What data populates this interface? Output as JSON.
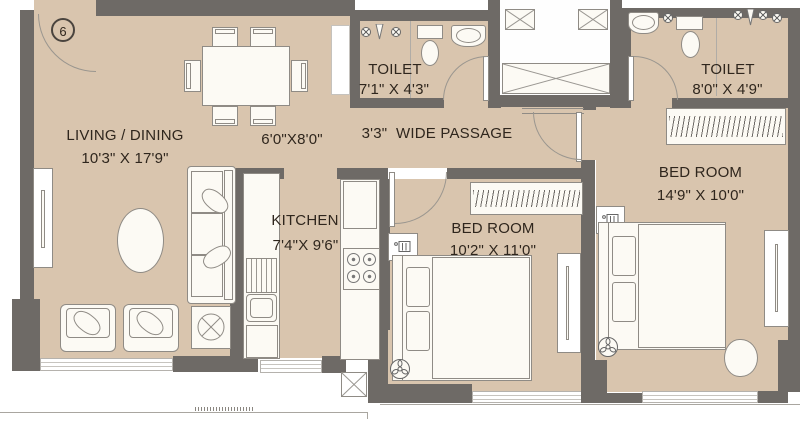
{
  "unit": {
    "number": "6"
  },
  "rooms": {
    "living": {
      "name": "LIVING / DINING",
      "dim": "10'3\" X 17'9\""
    },
    "foyer": {
      "dim": "6'0\"X8'0\""
    },
    "passage": {
      "name": "3'3\"  WIDE PASSAGE"
    },
    "toilet1": {
      "name": "TOILET",
      "dim": "7'1\" X 4'3\""
    },
    "toilet2": {
      "name": "TOILET",
      "dim": "8'0\" X 4'9\""
    },
    "kitchen": {
      "name": "KITCHEN",
      "dim": "7'4\"X 9'6\""
    },
    "bedroom1": {
      "name": "BED ROOM",
      "dim": "10'2\" X 11'0\""
    },
    "bedroom2": {
      "name": "BED ROOM",
      "dim": "14'9\" X 10'0\""
    }
  },
  "furniture": {
    "living": [
      "dining-table",
      "six-dining-chairs",
      "sofa",
      "two-armchairs",
      "oval-coffee-table",
      "tv-unit",
      "decor-table"
    ],
    "kitchen": [
      "sink-counter",
      "drainboard",
      "refrigerator",
      "gas-stove",
      "tall-cabinet"
    ],
    "bedroom1": [
      "double-bed",
      "wardrobe",
      "phone-side-table",
      "ceiling-fan",
      "dresser"
    ],
    "bedroom2": [
      "double-bed",
      "wardrobe",
      "phone-side-table",
      "ceiling-fan",
      "dresser",
      "chair"
    ],
    "toilet1": [
      "wc",
      "washbasin",
      "shower-taps"
    ],
    "toilet2": [
      "wc",
      "washbasin",
      "shower-taps"
    ],
    "common": [
      "lift-lobby",
      "service-ducts"
    ]
  },
  "symbols": {
    "ceiling_fan": "circle-with-3-blades",
    "decor_table": "circle-with-x",
    "lift": "box-with-x",
    "duct": "box-with-x",
    "door": "quarter-circle-arc",
    "tap": "circle-with-cross"
  },
  "colors": {
    "floor": "#d9c5ae",
    "wall": "#6e6a66",
    "outline": "#8f8b85",
    "text": "#2f261d",
    "background": "#ffffff"
  }
}
